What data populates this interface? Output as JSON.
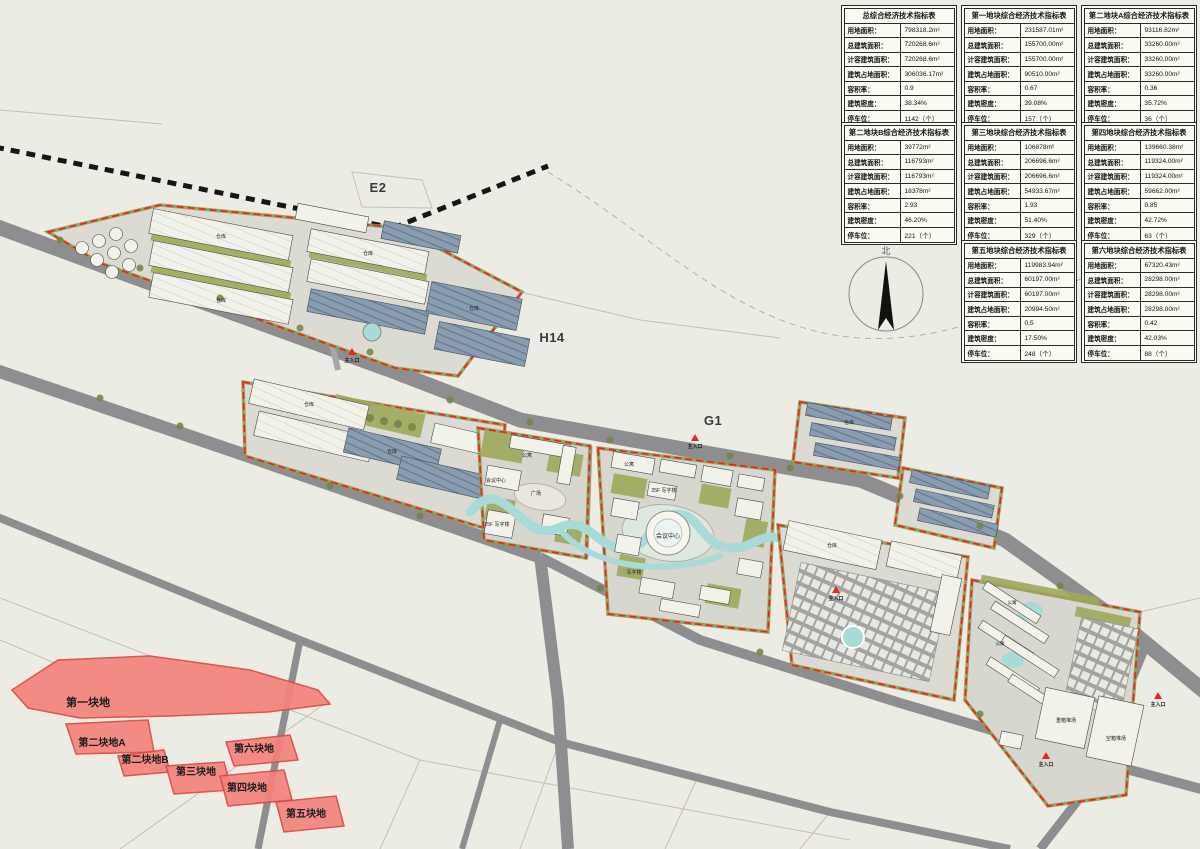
{
  "page": {
    "title": "规划总平面图"
  },
  "tables": {
    "row_labels": [
      "用地面积：",
      "总建筑面积：",
      "计容建筑面积：",
      "建筑占地面积：",
      "容积率：",
      "建筑密度：",
      "停车位："
    ],
    "items": [
      {
        "title": "总综合经济技术指标表",
        "values": [
          "798318.2m²",
          "720268.6m²",
          "720268.6m²",
          "306036.17m²",
          "0.9",
          "38.34%",
          "1142（个）"
        ]
      },
      {
        "title": "第一地块综合经济技术指标表",
        "values": [
          "231587.01m²",
          "155700.00m²",
          "155700.00m²",
          "90510.00m²",
          "0.67",
          "39.08%",
          "157（个）"
        ]
      },
      {
        "title": "第二地块A综合经济技术指标表",
        "values": [
          "93116.82m²",
          "33260.00m²",
          "33260.00m²",
          "33260.00m²",
          "0.36",
          "35.72%",
          "36（个）"
        ]
      },
      {
        "title": "第二地块B综合经济技术指标表",
        "values": [
          "39772m²",
          "116793m²",
          "116793m²",
          "18378m²",
          "2.93",
          "46.20%",
          "221（个）"
        ]
      },
      {
        "title": "第三地块综合经济技术指标表",
        "values": [
          "106878m²",
          "206696.6m²",
          "206696.6m²",
          "54933.67m²",
          "1.93",
          "51.40%",
          "329（个）"
        ]
      },
      {
        "title": "第四地块综合经济技术指标表",
        "values": [
          "139660.38m²",
          "119324.00m²",
          "119324.00m²",
          "59662.00m²",
          "0.85",
          "42.72%",
          "63（个）"
        ]
      },
      {
        "title": "第五地块综合经济技术指标表",
        "values": [
          "119983.94m²",
          "60197.00m²",
          "60197.00m²",
          "20994.50m²",
          "0.5",
          "17.50%",
          "248（个）"
        ]
      },
      {
        "title": "第六地块综合经济技术指标表",
        "values": [
          "67320.43m²",
          "28298.00m²",
          "28298.00m²",
          "28298.00m²",
          "0.42",
          "42.03%",
          "88（个）"
        ]
      }
    ]
  },
  "map": {
    "north_label": "北",
    "colors": {
      "bg": "#ECEBE4",
      "road": "#8E8E90",
      "rail": "#161616",
      "boundary": "#E8281E",
      "plotf": "#F3837B",
      "plots": "#D94A42",
      "water": "#A8DAD7",
      "green": "#9FA95B",
      "treec": "#6F8448"
    },
    "labels": [
      {
        "text": "E2",
        "x": 378,
        "y": 192,
        "s": 13,
        "cls": "zone"
      },
      {
        "text": "H14",
        "x": 552,
        "y": 342,
        "s": 13,
        "cls": "zone"
      },
      {
        "text": "G1",
        "x": 713,
        "y": 425,
        "s": 13,
        "cls": "zone"
      },
      {
        "text": "第一块地",
        "x": 88,
        "y": 706,
        "s": 11,
        "cls": "plot-name"
      },
      {
        "text": "第二块地A",
        "x": 102,
        "y": 746,
        "s": 10,
        "cls": "plot-name"
      },
      {
        "text": "第二块地B",
        "x": 145,
        "y": 763,
        "s": 10,
        "cls": "plot-name"
      },
      {
        "text": "第三块地",
        "x": 196,
        "y": 775,
        "s": 10,
        "cls": "plot-name"
      },
      {
        "text": "第六块地",
        "x": 254,
        "y": 752,
        "s": 10,
        "cls": "plot-name"
      },
      {
        "text": "第四块地",
        "x": 247,
        "y": 791,
        "s": 10,
        "cls": "plot-name"
      },
      {
        "text": "第五块地",
        "x": 306,
        "y": 817,
        "s": 10,
        "cls": "plot-name"
      },
      {
        "text": "公寓",
        "x": 527,
        "y": 457,
        "s": 5,
        "cls": "bldg"
      },
      {
        "text": "会议中心",
        "x": 496,
        "y": 482,
        "s": 5,
        "cls": "bldg"
      },
      {
        "text": "广场",
        "x": 536,
        "y": 495,
        "s": 5,
        "cls": "bldg"
      },
      {
        "text": "25F 写字楼",
        "x": 497,
        "y": 526,
        "s": 5,
        "cls": "bldg"
      },
      {
        "text": "公寓",
        "x": 629,
        "y": 466,
        "s": 5,
        "cls": "bldg"
      },
      {
        "text": "25F 写字楼",
        "x": 664,
        "y": 492,
        "s": 5,
        "cls": "bldg"
      },
      {
        "text": "会议中心",
        "x": 668,
        "y": 538,
        "s": 6,
        "cls": "bldg"
      },
      {
        "text": "写字楼",
        "x": 634,
        "y": 574,
        "s": 5,
        "cls": "bldg"
      },
      {
        "text": "仓库",
        "x": 221,
        "y": 238,
        "s": 5,
        "cls": "bldg"
      },
      {
        "text": "仓库",
        "x": 221,
        "y": 302,
        "s": 5,
        "cls": "bldg"
      },
      {
        "text": "仓库",
        "x": 368,
        "y": 255,
        "s": 5,
        "cls": "bldg"
      },
      {
        "text": "仓库",
        "x": 474,
        "y": 310,
        "s": 5,
        "cls": "bldg"
      },
      {
        "text": "仓库",
        "x": 309,
        "y": 406,
        "s": 5,
        "cls": "bldg"
      },
      {
        "text": "仓库",
        "x": 392,
        "y": 453,
        "s": 5,
        "cls": "bldg"
      },
      {
        "text": "仓库",
        "x": 849,
        "y": 424,
        "s": 5,
        "cls": "bldg"
      },
      {
        "text": "仓库",
        "x": 832,
        "y": 547,
        "s": 5,
        "cls": "bldg"
      },
      {
        "text": "公寓",
        "x": 1012,
        "y": 604,
        "s": 4.5,
        "cls": "bldg"
      },
      {
        "text": "公寓",
        "x": 1000,
        "y": 645,
        "s": 4.5,
        "cls": "bldg"
      },
      {
        "text": "重箱堆场",
        "x": 1066,
        "y": 722,
        "s": 5,
        "cls": "bldg"
      },
      {
        "text": "空箱堆场",
        "x": 1116,
        "y": 740,
        "s": 5,
        "cls": "bldg"
      },
      {
        "text": "主入口",
        "x": 352,
        "y": 362,
        "s": 5,
        "cls": "entrance"
      },
      {
        "text": "主入口",
        "x": 695,
        "y": 448,
        "s": 5,
        "cls": "entrance"
      },
      {
        "text": "主入口",
        "x": 836,
        "y": 600,
        "s": 5,
        "cls": "entrance"
      },
      {
        "text": "主入口",
        "x": 1158,
        "y": 706,
        "s": 5,
        "cls": "entrance"
      },
      {
        "text": "主入口",
        "x": 1046,
        "y": 766,
        "s": 5,
        "cls": "entrance"
      }
    ]
  }
}
